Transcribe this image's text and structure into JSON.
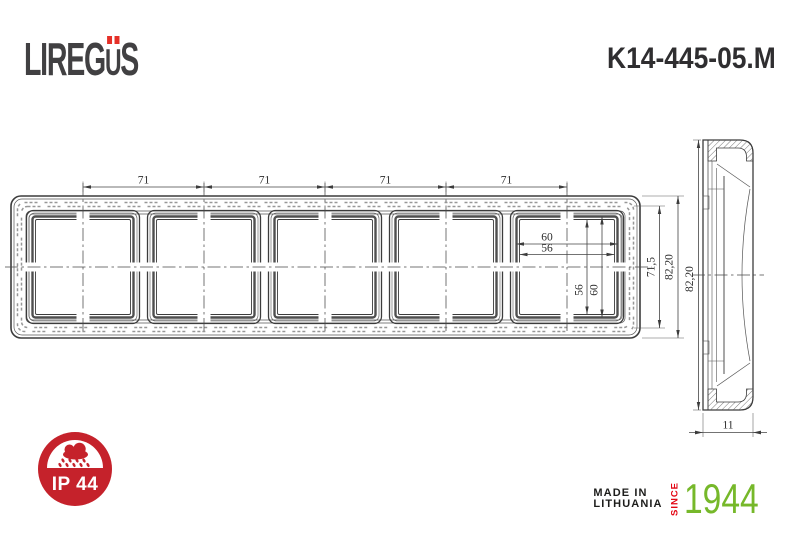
{
  "brand": {
    "logo_prefix": "LIREG",
    "logo_umlaut_letter": "U",
    "logo_suffix": "S"
  },
  "model_number": "K14-445-05.M",
  "drawing": {
    "front_view": {
      "spacing_dims": [
        "71",
        "71",
        "71",
        "71"
      ],
      "window_outer_width": "60",
      "window_inner_width": "56",
      "window_inner_height": "56",
      "window_outer_height": "60",
      "frame_inner_height": "71,5",
      "frame_overall_height": "82,20"
    },
    "side_view": {
      "overall_height": "82,20",
      "depth": "11"
    }
  },
  "badge": {
    "label": "IP 44"
  },
  "footer": {
    "made_in_line1": "MADE IN",
    "made_in_line2": "LITHUANIA",
    "since_label": "SINCE",
    "year": "1944"
  },
  "colors": {
    "brand_red": "#e53028",
    "badge_red": "#c5222b",
    "since_red": "#e30613",
    "year_green": "#76b82a",
    "ink": "#3c3c3c"
  }
}
